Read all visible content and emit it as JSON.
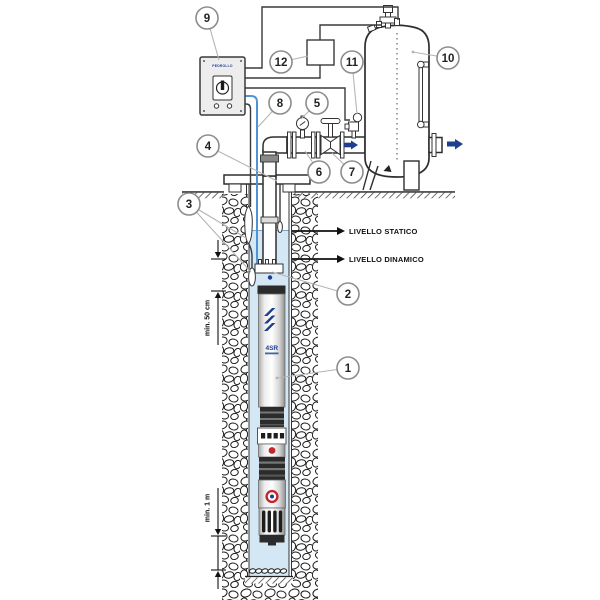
{
  "callouts": [
    "1",
    "2",
    "3",
    "4",
    "5",
    "6",
    "7",
    "8",
    "9",
    "10",
    "11",
    "12"
  ],
  "labels": {
    "static_level": "LIVELLO STATICO",
    "dynamic_level": "LIVELLO DINAMICO",
    "min_pump_submersion": "min. 50 cm",
    "min_bottom_clearance": "min. 1 m"
  },
  "pump": {
    "logo_text": "4SR"
  },
  "panel": {
    "logo_text": "PEDROLLO"
  },
  "colors": {
    "accent": "#1d3f8f",
    "cable": "#4f93d2",
    "water": "#d4e7f4",
    "red": "#c3272b",
    "line": "#2e2e2e",
    "leader": "#b5b5b5"
  }
}
